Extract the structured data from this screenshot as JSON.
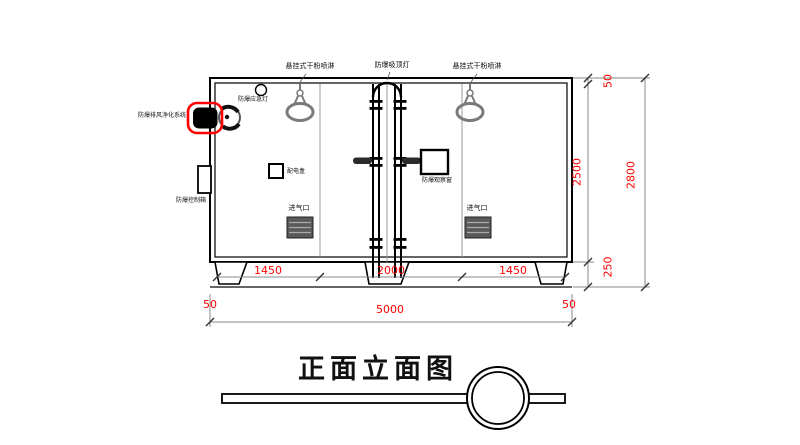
{
  "drawing": {
    "title": "正面立面图",
    "equipment_labels": {
      "sprinkler_left": "悬挂式干粉喷淋",
      "ceiling_lamp": "防爆吸顶灯",
      "sprinkler_right": "悬挂式干粉喷淋",
      "emergency_lamp": "防爆应急灯",
      "exhaust_purification_system": "防爆排风净化系统",
      "control_box": "防爆控制箱",
      "power_box": "配电盒",
      "observation_window": "防爆观察窗",
      "air_inlet_left": "进气口",
      "air_inlet_right": "进气口"
    },
    "dimensions": {
      "bay_left": "1450",
      "bay_center": "2000",
      "bay_right": "1450",
      "offset_bottom_left": "50",
      "total_width": "5000",
      "offset_bottom_right": "50",
      "offset_top_right": "50",
      "interior_height": "2500",
      "base_height": "250",
      "total_height": "2800"
    },
    "colors": {
      "dimension_text": "#ff0000",
      "highlight_box": "#ff0000",
      "line": "#000000",
      "fixture_gray": "#7a7a7a"
    }
  }
}
